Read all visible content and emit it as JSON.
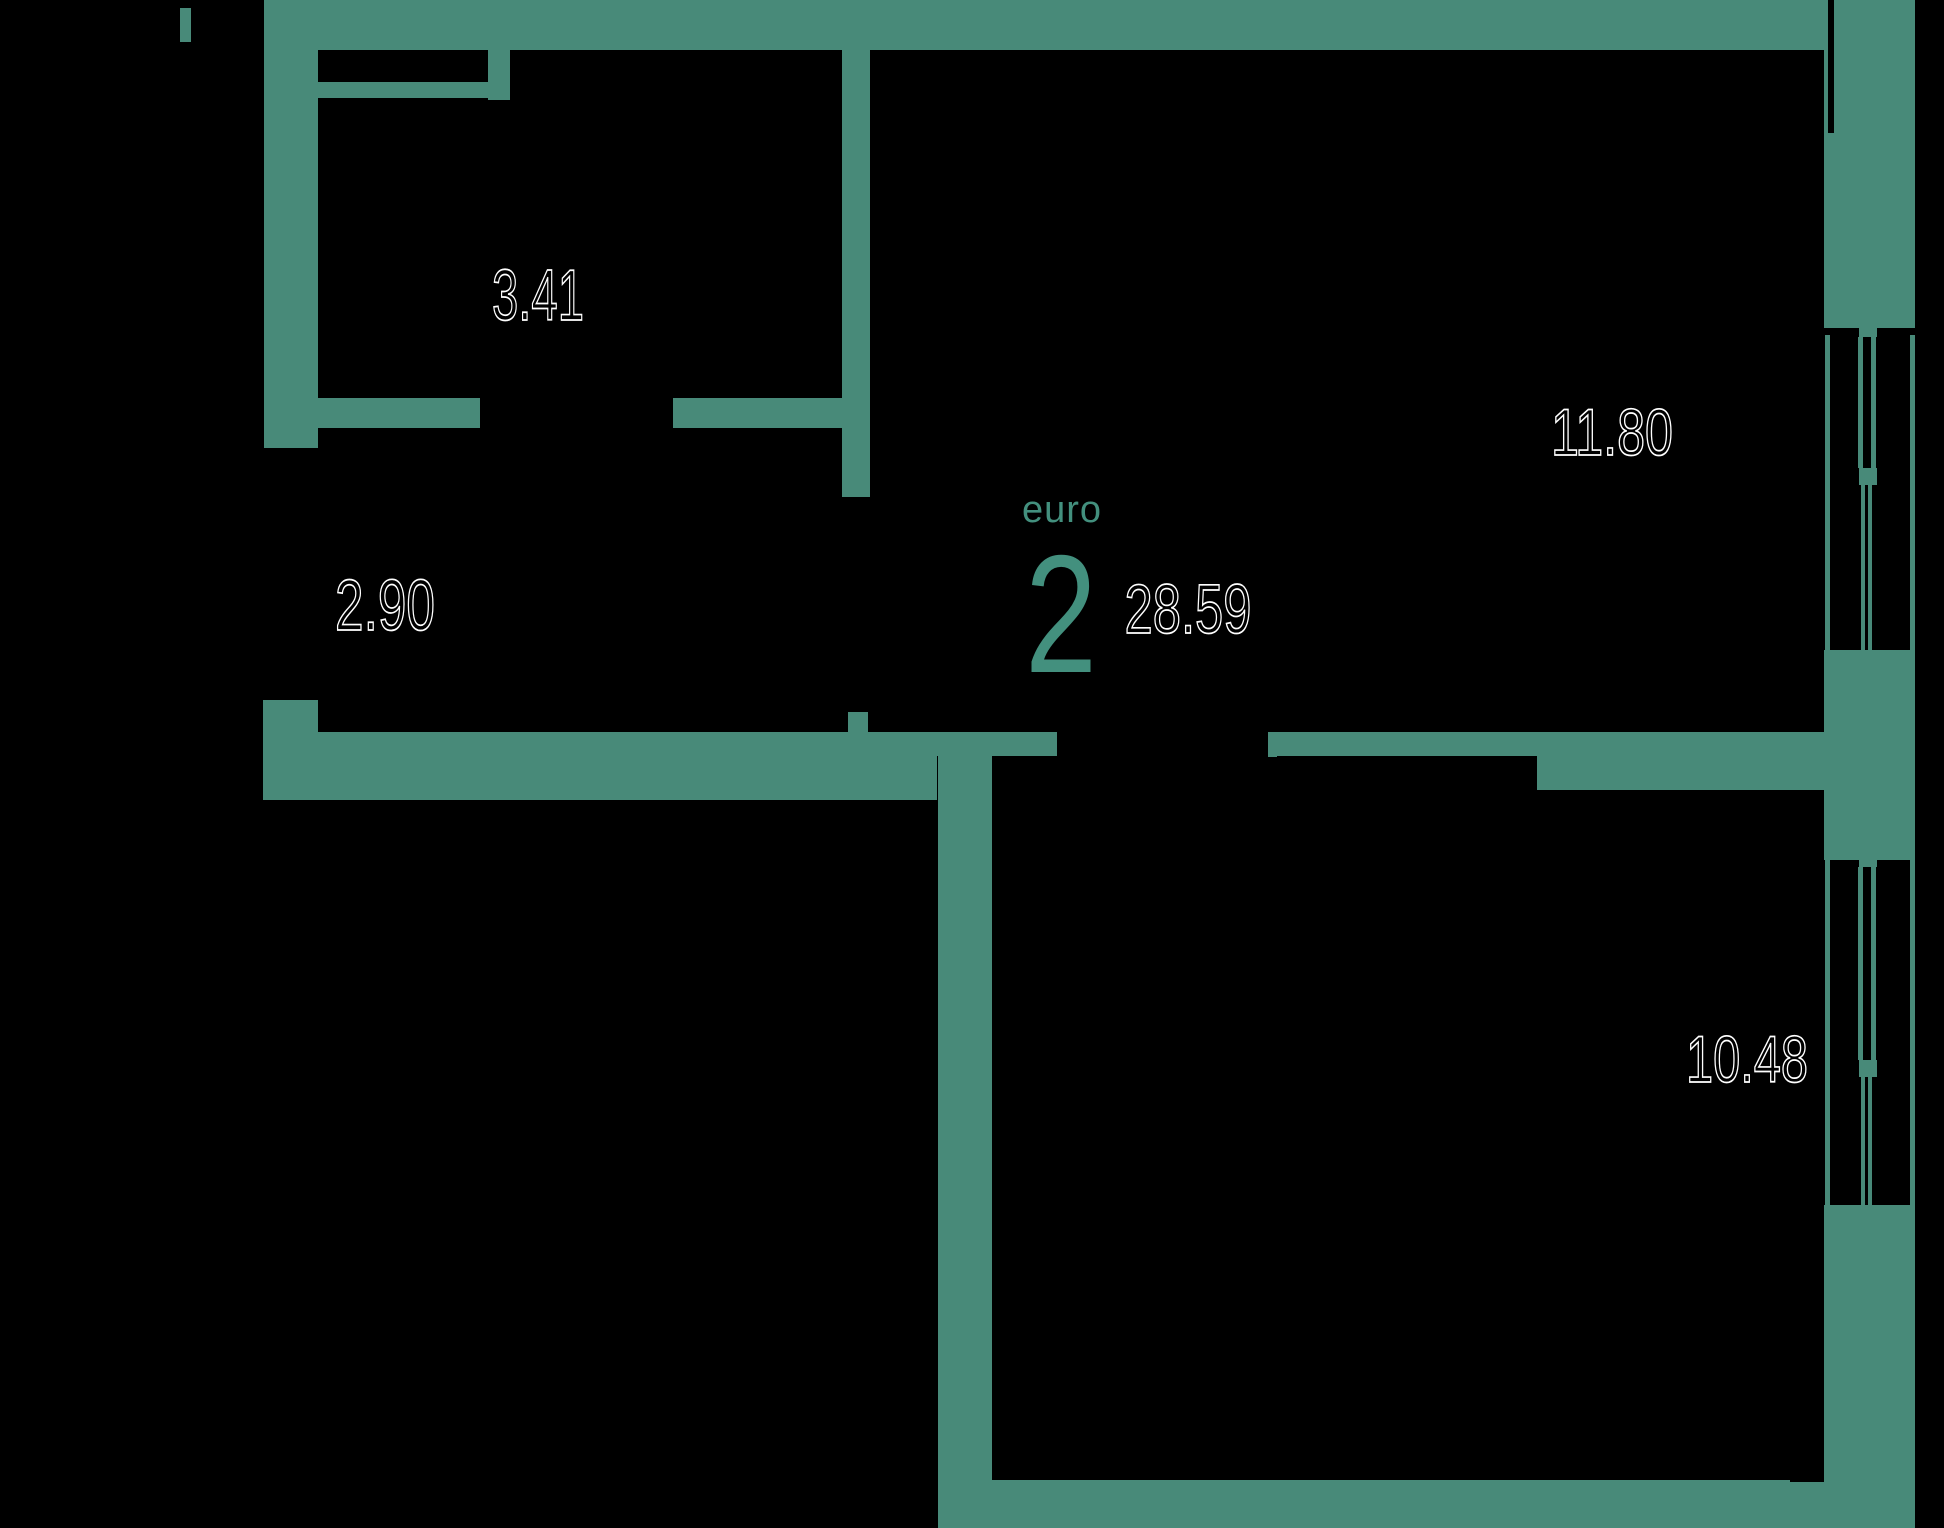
{
  "plan": {
    "title": "apartment-floor-plan",
    "unit_badge": {
      "type_label": "euro",
      "rooms_count": "2",
      "total_area": "28.59"
    },
    "rooms": [
      {
        "id": "balcony-top-left",
        "area": "3.41"
      },
      {
        "id": "hallway-left",
        "area": "2.90"
      },
      {
        "id": "living-room-top-right",
        "area": "11.80"
      },
      {
        "id": "bedroom-bottom-right",
        "area": "10.48"
      }
    ],
    "colors": {
      "wall": "#488a79",
      "accent_text": "#43907e",
      "outline_text": "#ffffff",
      "background": "#000000"
    }
  }
}
